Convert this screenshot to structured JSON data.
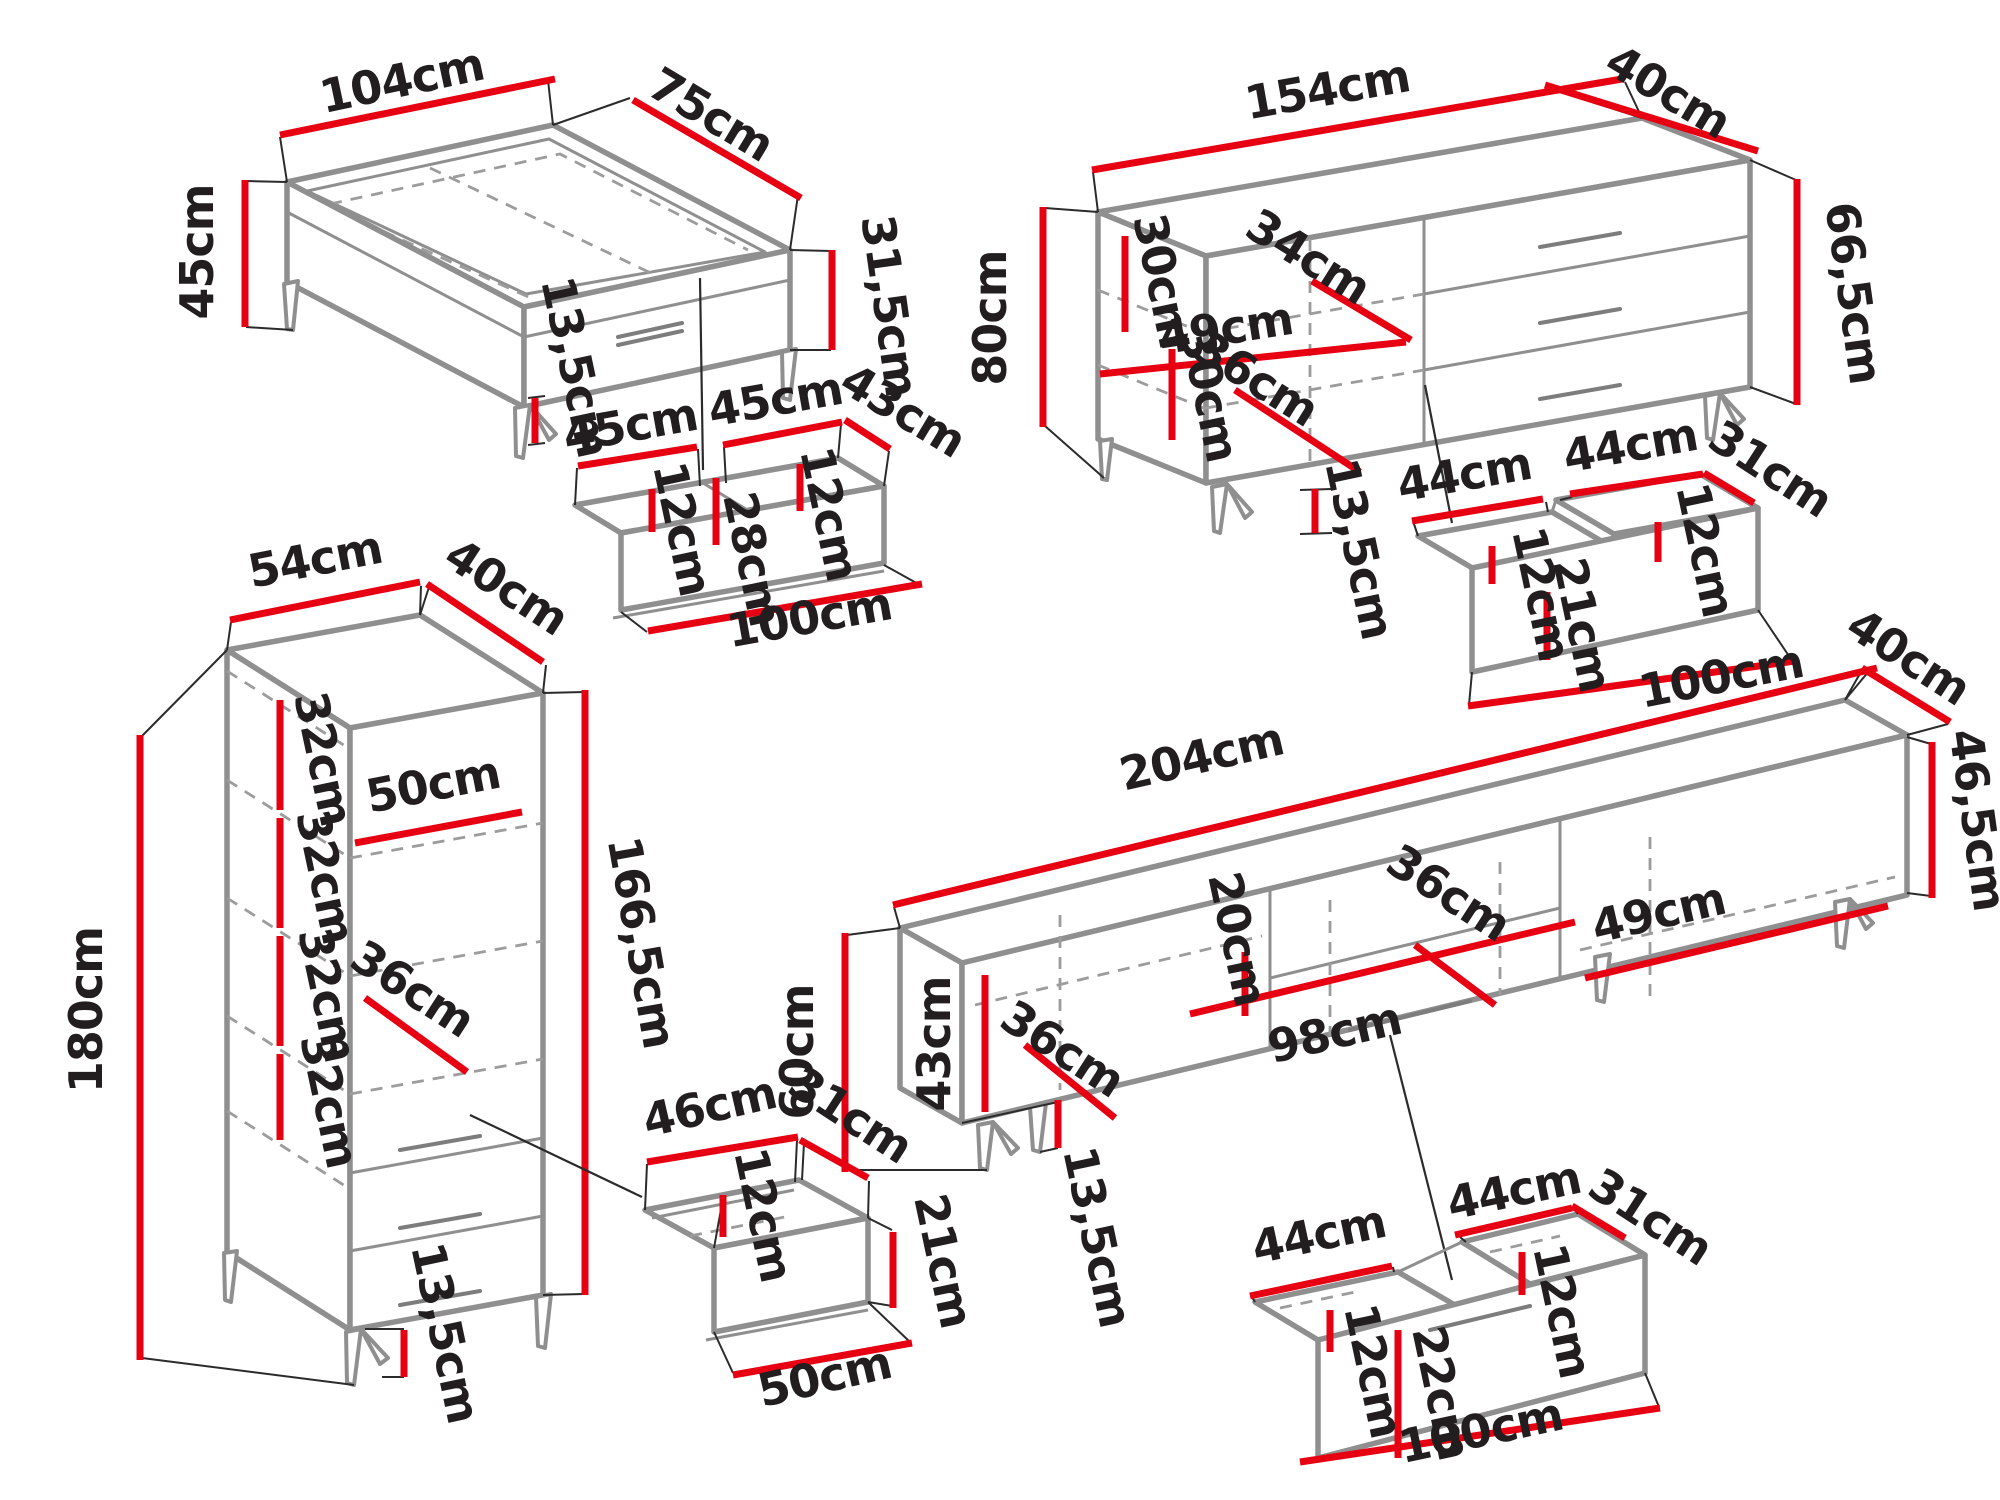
{
  "title": "Furniture set dimension diagram",
  "unit": "cm",
  "canvas": {
    "width": 2000,
    "height": 1500,
    "background": "#ffffff"
  },
  "colors": {
    "dimension_red": "#e60012",
    "furniture_gray": "#8f8f8f",
    "text_black": "#221e1f"
  },
  "pieces": [
    {
      "id": "coffee-table",
      "label": "Coffee table",
      "dimensions": {
        "width": "104cm",
        "depth": "75cm",
        "height": "45cm",
        "body_height": "31,5cm",
        "drawer_front": "13,5cm"
      }
    },
    {
      "id": "coffee-table-drawer",
      "label": "Under-table double drawer",
      "dimensions": {
        "compartment_left": "45cm",
        "compartment_right": "45cm",
        "depth": "43cm",
        "inner_height_left": "12cm",
        "inner_height_right": "12cm",
        "front_height": "28cm",
        "length": "100cm"
      }
    },
    {
      "id": "sideboard",
      "label": "Sideboard / chest",
      "dimensions": {
        "width": "154cm",
        "depth": "40cm",
        "height": "80cm",
        "body_height": "66,5cm",
        "shelf_gap_1": "30cm",
        "shelf_gap_2": "30cm",
        "inner_width_door": "34cm",
        "inner_width": "49cm",
        "inner_diagonal": "36cm",
        "leg_height": "13,5cm"
      }
    },
    {
      "id": "sideboard-drawer",
      "label": "Sideboard double drawer",
      "dimensions": {
        "compartment_left": "44cm",
        "compartment_right": "44cm",
        "depth": "31cm",
        "inner_height_left": "12cm",
        "inner_height_right": "12cm",
        "front_height": "21cm",
        "length": "100cm"
      }
    },
    {
      "id": "tall-cabinet",
      "label": "Tall cabinet",
      "dimensions": {
        "width": "54cm",
        "depth": "40cm",
        "height": "180cm",
        "body_height": "166,5cm",
        "shelf_gaps": [
          "32cm",
          "32cm",
          "32cm",
          "32cm"
        ],
        "shelf_width": "50cm",
        "inner_diagonal": "36cm",
        "leg_height": "13,5cm"
      }
    },
    {
      "id": "tv-stand",
      "label": "TV stand",
      "dimensions": {
        "width": "204cm",
        "depth": "40cm",
        "height": "60cm",
        "body_height": "46,5cm",
        "inner_height": "43cm",
        "shelf_gap": "20cm",
        "inner_diagonal_shelf": "36cm",
        "inner_diagonal_door": "36cm",
        "inner_width_right": "49cm",
        "shelf_length": "98cm",
        "leg_height": "13,5cm"
      }
    },
    {
      "id": "tv-stand-drawer-small",
      "label": "Small drawer",
      "dimensions": {
        "width": "46cm",
        "depth": "31cm",
        "inner_height": "12cm",
        "front_height": "21cm",
        "length": "50cm"
      }
    },
    {
      "id": "tv-stand-drawer-large",
      "label": "Large double drawer",
      "dimensions": {
        "compartment_left": "44cm",
        "compartment_right": "44cm",
        "depth": "31cm",
        "inner_height_left": "12cm",
        "inner_height_right": "12cm",
        "front_height": "22cm",
        "length": "100cm"
      }
    }
  ],
  "dimension_labels": [
    {
      "name": "p1-width",
      "text": "104cm",
      "x": 405,
      "y": 96,
      "rot": -12
    },
    {
      "name": "p1-depth",
      "text": "75cm",
      "x": 703,
      "y": 128,
      "rot": 31
    },
    {
      "name": "p1-height",
      "text": "45cm",
      "x": 213,
      "y": 252,
      "rot": -90
    },
    {
      "name": "p1-side",
      "text": "31,5cm",
      "x": 874,
      "y": 308,
      "rot": 82
    },
    {
      "name": "p1-drawer",
      "text": "13,5cm",
      "x": 560,
      "y": 370,
      "rot": 78
    },
    {
      "name": "p2-w1",
      "text": "45cm",
      "x": 633,
      "y": 441,
      "rot": -10
    },
    {
      "name": "p2-w2",
      "text": "45cm",
      "x": 778,
      "y": 415,
      "rot": -10
    },
    {
      "name": "p2-depth",
      "text": "43cm",
      "x": 895,
      "y": 424,
      "rot": 31
    },
    {
      "name": "p2-h1",
      "text": "12cm",
      "x": 667,
      "y": 532,
      "rot": 78
    },
    {
      "name": "p2-h2",
      "text": "12cm",
      "x": 814,
      "y": 517,
      "rot": 78
    },
    {
      "name": "p2-front",
      "text": "28cm",
      "x": 737,
      "y": 562,
      "rot": 78
    },
    {
      "name": "p2-length",
      "text": "100cm",
      "x": 812,
      "y": 633,
      "rot": -10
    },
    {
      "name": "p3-width",
      "text": "154cm",
      "x": 1330,
      "y": 105,
      "rot": -10
    },
    {
      "name": "p3-depth",
      "text": "40cm",
      "x": 1660,
      "y": 105,
      "rot": 31
    },
    {
      "name": "p3-height",
      "text": "80cm",
      "x": 1006,
      "y": 318,
      "rot": -90
    },
    {
      "name": "p3-side",
      "text": "66,5cm",
      "x": 1838,
      "y": 295,
      "rot": 82
    },
    {
      "name": "p3-shelf1",
      "text": "30cm",
      "x": 1147,
      "y": 284,
      "rot": 78
    },
    {
      "name": "p3-shelf2",
      "text": "30cm",
      "x": 1194,
      "y": 398,
      "rot": 78
    },
    {
      "name": "p3-inner1",
      "text": "34cm",
      "x": 1300,
      "y": 270,
      "rot": 32
    },
    {
      "name": "p3-inner2",
      "text": "49cm",
      "x": 1228,
      "y": 344,
      "rot": -9
    },
    {
      "name": "p3-diag",
      "text": "36cm",
      "x": 1248,
      "y": 392,
      "rot": 32
    },
    {
      "name": "p3-legs",
      "text": "13,5cm",
      "x": 1344,
      "y": 552,
      "rot": 78
    },
    {
      "name": "p4-w1",
      "text": "44cm",
      "x": 1467,
      "y": 490,
      "rot": -10
    },
    {
      "name": "p4-w2",
      "text": "44cm",
      "x": 1633,
      "y": 461,
      "rot": -10
    },
    {
      "name": "p4-depth",
      "text": "31cm",
      "x": 1762,
      "y": 482,
      "rot": 33
    },
    {
      "name": "p4-h1",
      "text": "12cm",
      "x": 1526,
      "y": 597,
      "rot": 78
    },
    {
      "name": "p4-h2",
      "text": "12cm",
      "x": 1690,
      "y": 553,
      "rot": 78
    },
    {
      "name": "p4-front",
      "text": "21cm",
      "x": 1567,
      "y": 628,
      "rot": 78
    },
    {
      "name": "p4-length",
      "text": "100cm",
      "x": 1724,
      "y": 692,
      "rot": -11
    },
    {
      "name": "p5-width",
      "text": "54cm",
      "x": 318,
      "y": 575,
      "rot": -11
    },
    {
      "name": "p5-depth",
      "text": "40cm",
      "x": 498,
      "y": 600,
      "rot": 33
    },
    {
      "name": "p5-height",
      "text": "180cm",
      "x": 102,
      "y": 1010,
      "rot": -90
    },
    {
      "name": "p5-side",
      "text": "166,5cm",
      "x": 626,
      "y": 945,
      "rot": 80
    },
    {
      "name": "p5-gap1",
      "text": "32cm",
      "x": 308,
      "y": 762,
      "rot": 78
    },
    {
      "name": "p5-gap2",
      "text": "32cm",
      "x": 310,
      "y": 880,
      "rot": 78
    },
    {
      "name": "p5-gap3",
      "text": "32cm",
      "x": 312,
      "y": 998,
      "rot": 78
    },
    {
      "name": "p5-gap4",
      "text": "32cm",
      "x": 314,
      "y": 1104,
      "rot": 78
    },
    {
      "name": "p5-shelf",
      "text": "50cm",
      "x": 436,
      "y": 800,
      "rot": -11
    },
    {
      "name": "p5-diag",
      "text": "36cm",
      "x": 404,
      "y": 1002,
      "rot": 33
    },
    {
      "name": "p5-legs",
      "text": "13,5cm",
      "x": 430,
      "y": 1336,
      "rot": 78
    },
    {
      "name": "p6-width",
      "text": "204cm",
      "x": 1205,
      "y": 772,
      "rot": -13
    },
    {
      "name": "p6-depth",
      "text": "40cm",
      "x": 1900,
      "y": 670,
      "rot": 33
    },
    {
      "name": "p6-side",
      "text": "46,5cm",
      "x": 1962,
      "y": 822,
      "rot": 82
    },
    {
      "name": "p6-height",
      "text": "60cm",
      "x": 813,
      "y": 1052,
      "rot": -90
    },
    {
      "name": "p6-inner-h",
      "text": "43cm",
      "x": 950,
      "y": 1044,
      "rot": -90
    },
    {
      "name": "p6-shelf-h",
      "text": "20cm",
      "x": 1222,
      "y": 942,
      "rot": 78
    },
    {
      "name": "p6-diag1",
      "text": "36cm",
      "x": 1440,
      "y": 906,
      "rot": 33
    },
    {
      "name": "p6-right",
      "text": "49cm",
      "x": 1662,
      "y": 928,
      "rot": -13
    },
    {
      "name": "p6-shelf-l",
      "text": "98cm",
      "x": 1338,
      "y": 1048,
      "rot": -13
    },
    {
      "name": "p6-diag2",
      "text": "36cm",
      "x": 1054,
      "y": 1062,
      "rot": 33
    },
    {
      "name": "p6-legs",
      "text": "13,5cm",
      "x": 1082,
      "y": 1240,
      "rot": 78
    },
    {
      "name": "p7-width",
      "text": "46cm",
      "x": 713,
      "y": 1122,
      "rot": -13
    },
    {
      "name": "p7-depth",
      "text": "31cm",
      "x": 842,
      "y": 1128,
      "rot": 33
    },
    {
      "name": "p7-inner",
      "text": "12cm",
      "x": 748,
      "y": 1218,
      "rot": 78
    },
    {
      "name": "p7-front",
      "text": "21cm",
      "x": 928,
      "y": 1264,
      "rot": 78
    },
    {
      "name": "p7-length",
      "text": "50cm",
      "x": 828,
      "y": 1392,
      "rot": -13
    },
    {
      "name": "p8-w1",
      "text": "44cm",
      "x": 1322,
      "y": 1250,
      "rot": -12
    },
    {
      "name": "p8-w2",
      "text": "44cm",
      "x": 1517,
      "y": 1206,
      "rot": -12
    },
    {
      "name": "p8-depth",
      "text": "31cm",
      "x": 1642,
      "y": 1230,
      "rot": 33
    },
    {
      "name": "p8-h1",
      "text": "12cm",
      "x": 1358,
      "y": 1374,
      "rot": 78
    },
    {
      "name": "p8-h2",
      "text": "12cm",
      "x": 1547,
      "y": 1314,
      "rot": 78
    },
    {
      "name": "p8-front",
      "text": "22cm",
      "x": 1426,
      "y": 1396,
      "rot": 78
    },
    {
      "name": "p8-length",
      "text": "100cm",
      "x": 1484,
      "y": 1446,
      "rot": -12
    }
  ]
}
